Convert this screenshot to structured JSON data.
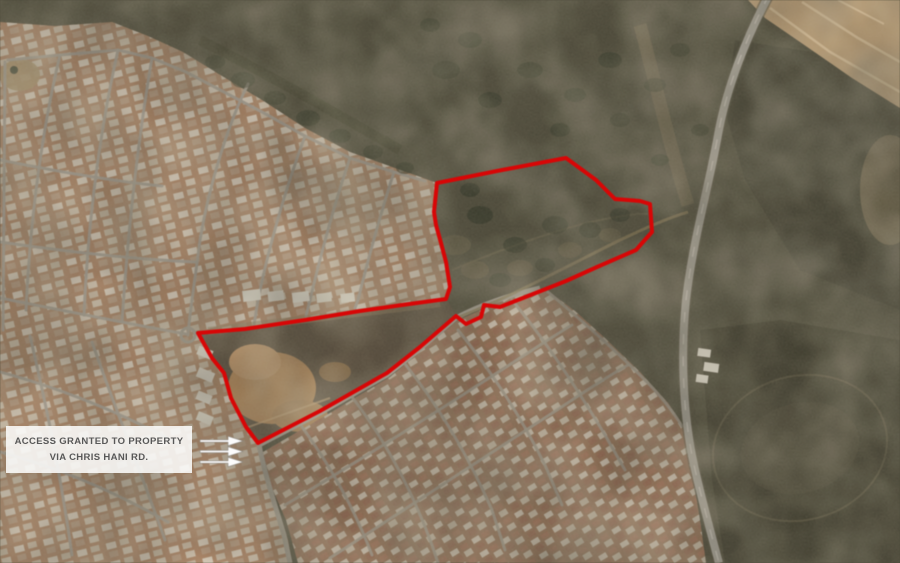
{
  "callout": {
    "line1": "ACCESS GRANTED TO PROPERTY",
    "line2": "VIA CHRIS HANI RD."
  },
  "boundary": {
    "color": "#e60000",
    "points": "437,183 502,170 566,158 596,180 615,199 640,201 650,204 652,232 643,242 636,250 597,267 566,281 528,296 500,307 484,305 481,317 466,324 456,316 420,347 387,373 320,411 258,443 246,427 231,398 224,373 212,358 198,333 245,329 305,320 360,311 402,305 424,302 446,299 450,287 446,262 441,243 436,225 434,212"
  },
  "arrows": {
    "icon": "right-arrow-icon",
    "count": "3",
    "direction": "right"
  }
}
